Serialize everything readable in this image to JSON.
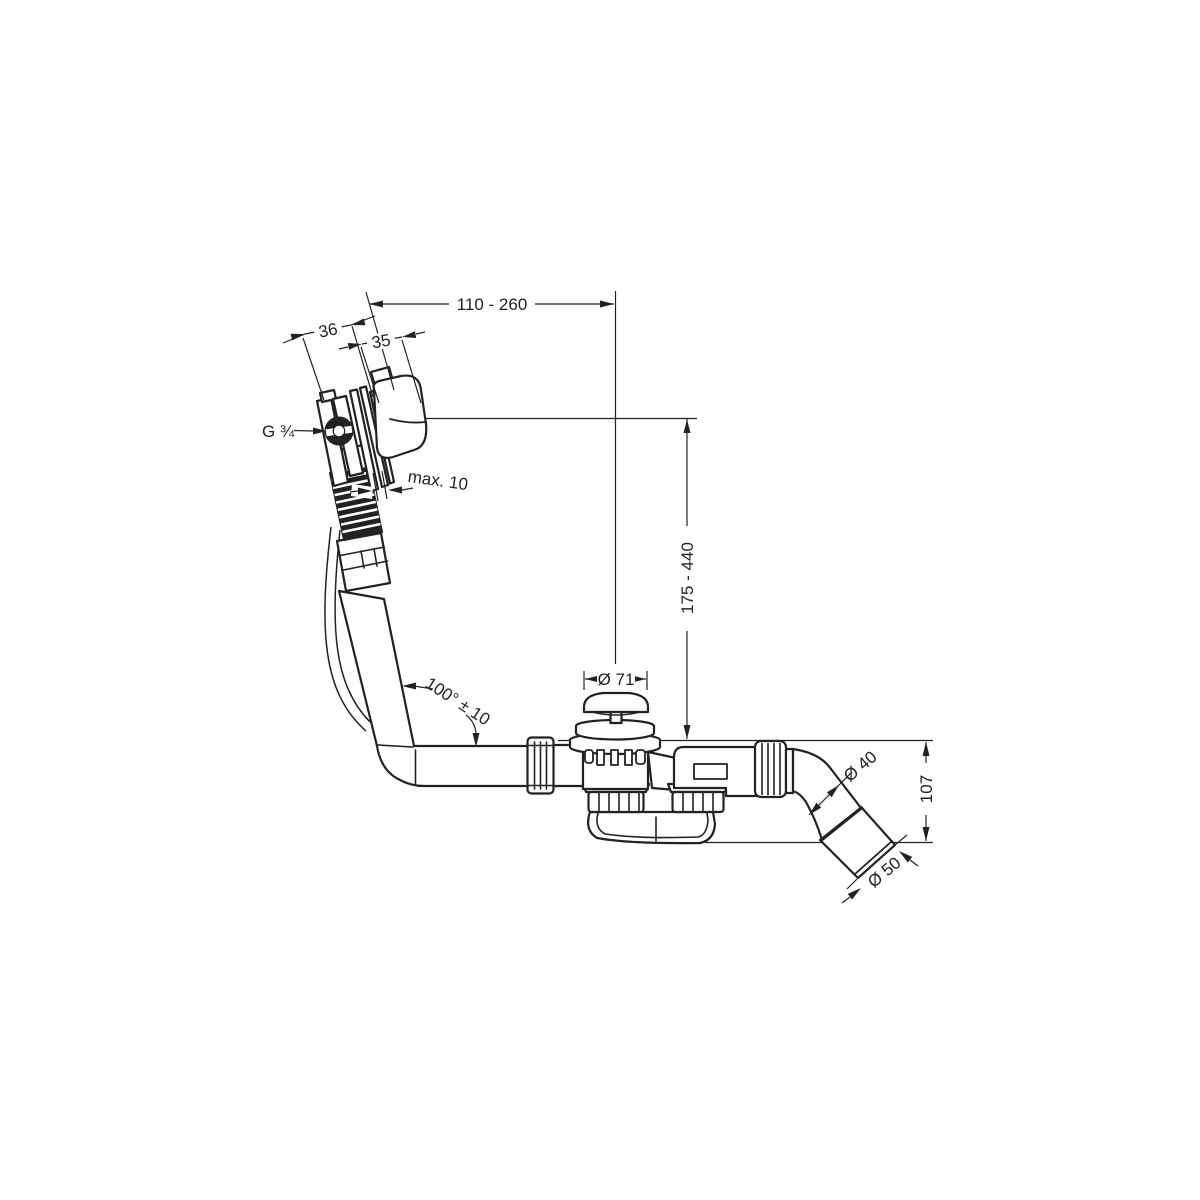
{
  "labels": {
    "width_range": "110 - 260",
    "overflow_body_depth": "36",
    "escutcheon_depth": "35",
    "thread_size": "G ¾",
    "wall_clearance": "max. 10",
    "height_range": "175 - 440",
    "plug_diameter": "Ø 71",
    "hose_angle": "100° ± 10",
    "outlet_pipe_diameter": "Ø 40",
    "trap_depth": "107",
    "outlet_sleeve_diameter": "Ø 50"
  },
  "colors": {
    "line": "#222222",
    "background": "#ffffff"
  }
}
